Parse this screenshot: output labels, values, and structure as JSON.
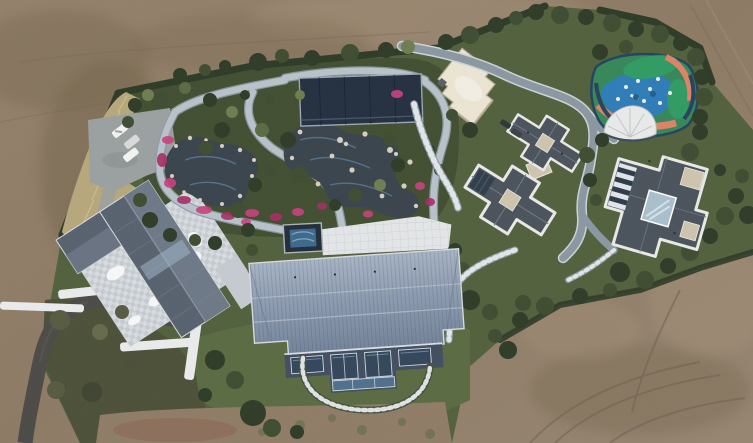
{
  "image": {
    "kind": "aerial-drone-photograph",
    "description": "Top-down drone photograph of a landscaped private estate compound surrounded by bare brown earth. Inside the dark hedge boundary: a parking lot with three white cars, a curved asphalt driveway, a house with gray gabled roof over a light stone courtyard, an elaborate water garden with winding pale paths, dark ponds, white rocks and magenta azalea beds, a dark navy pavilion, a cream flat-roofed building, two modern villas with dark gray hipped roofs and white trim, a colorful blue-green-coral playground with a white tensile canopy, a large blue standing-seam barn-style roof building with glass facade, and winding gray service roads with stone steps.",
    "width_px": 753,
    "height_px": 443
  },
  "elements": [
    {
      "name": "dirt-terrain",
      "desc": "bare brown graded earth with tire tracks surrounding the estate"
    },
    {
      "name": "boundary-hedge",
      "desc": "dark green clipped hedge along the property line"
    },
    {
      "name": "tall-grass-band",
      "desc": "strip of tall yellow ornamental grass along west edge"
    },
    {
      "name": "parking-lot",
      "desc": "gray parking pad with three white/silver cars"
    },
    {
      "name": "driveway",
      "desc": "dark asphalt drive curving to bottom-left corner"
    },
    {
      "name": "left-house",
      "desc": "gray gable-roof residence over pale checkered stone courtyard with white retaining walls"
    },
    {
      "name": "water-garden",
      "desc": "winding light stone paths, two dark ponds, white boulders, magenta azalea beds, clipped shrubs"
    },
    {
      "name": "garden-pavilion",
      "desc": "dark navy rectangular pavilion roof"
    },
    {
      "name": "rock-pool",
      "desc": "blue pool area with white rock islands below pavilion"
    },
    {
      "name": "plunge-pool",
      "desc": "small square dark-rimmed blue pool beside white terrace"
    },
    {
      "name": "white-terrace",
      "desc": "white gridded patio"
    },
    {
      "name": "cream-building",
      "desc": "cream flat-roofed building with stepped corners"
    },
    {
      "name": "villa-north",
      "desc": "cross-plan villa, dark hipped roofs, white trim, tan flat decks"
    },
    {
      "name": "villa-east",
      "desc": "modern villa with white-trimmed dark roof, glass courtyard atrium and striped skylights"
    },
    {
      "name": "playground",
      "desc": "organic painted playground in blue, green and coral with white play equipment and white tensile canopy"
    },
    {
      "name": "service-road",
      "desc": "blue-gray winding road with pale curbs linking buildings"
    },
    {
      "name": "stone-steps",
      "desc": "white-runged stone stair paths through planting"
    },
    {
      "name": "barn-building",
      "desc": "large blue-gray standing-seam gambrel roof with glass south facade and curved stepping-stone arc"
    },
    {
      "name": "lawn",
      "desc": "green lawns around the barn building"
    }
  ],
  "palette": {
    "dirt_base": "#8f7c66",
    "dirt_dark": "#78684f",
    "dirt_light": "#a4917a",
    "dirt_red": "#8a6452",
    "track": "#6e6253",
    "lawn": "#51603c",
    "lawn_light": "#5a6a41",
    "garden_green": "#414e30",
    "scrub": "#4c5038",
    "hedge": "#2c3a26",
    "tree_dark": "#2e3b27",
    "tree_mid": "#3e4c31",
    "tree_light": "#5a6a43",
    "tree_olive": "#6e7d50",
    "tall_grass": "#b6a77b",
    "grass_streak": "#d2c494",
    "path_light": "#b8c2ca",
    "path_edge": "#8e9aa4",
    "water": "#39434c",
    "water_streak": "#5e82a0",
    "rock": "#d6cfbd",
    "flower_pink": "#c9407e",
    "flower_pink2": "#a82c66",
    "pavilion": "#232f40",
    "pavilion_frame": "#9aa6b4",
    "pool_border": "#222c38",
    "pool_water": "#3d688c",
    "pool_swirl": "#7fa6c0",
    "terrace": "#e3e6e8",
    "terrace_line": "#c6cacd",
    "white_bldg": "#ece5d4",
    "white_bldg_edge": "#b5ad98",
    "villa_roof": "#4a525b",
    "villa_trim": "#e9e9e7",
    "villa_tan": "#cfc5ad",
    "villa_glass": "#a9bfcc",
    "villa_glass_dark": "#2c3a48",
    "villa_ridge": "#6f7983",
    "road": "#8a97a2",
    "road_light": "#ccd3d8",
    "barn_top": "#a4b1c3",
    "barn_bottom": "#74849b",
    "barn_line": "#bac3d0",
    "barn_facade": "#414e60",
    "barn_glass": "#33465a",
    "barn_glass_light": "#4e708c",
    "barn_frame": "#cfd8e0",
    "asphalt": "#4b4a46",
    "pave": "#9aa0a0",
    "courtyard": "#c6cbd1",
    "courtyard_light": "#d7dce0",
    "roof_left": "#57616f",
    "roof_left_light": "#6d7887",
    "wall_white": "#e9ebed",
    "car_white": "#f3f3f1",
    "car_silver": "#d9dbdb",
    "car_dark": "#30353b",
    "pg_base": "#35875a",
    "pg_green": "#2f9b63",
    "pg_blue": "#2d7cb8",
    "pg_coral": "#de8266",
    "pg_navy": "#24425e",
    "pg_white": "#eceded"
  }
}
